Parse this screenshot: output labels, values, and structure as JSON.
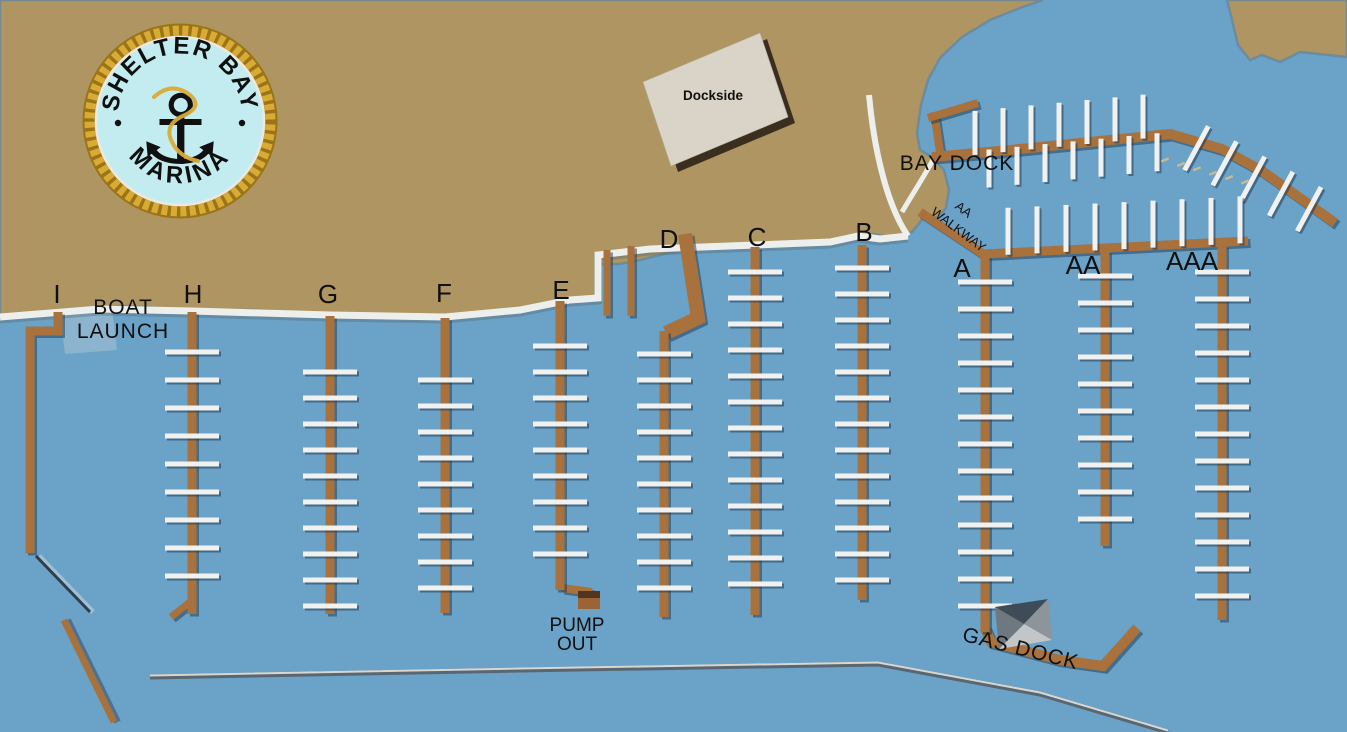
{
  "title": "Shelter Bay Marina map",
  "logo": {
    "arc_top": "SHELTER BAY",
    "arc_bottom": "MARINA",
    "dot": "•",
    "anchor_icon": "⚓"
  },
  "colors": {
    "water": "#6ba2c8",
    "land": "#ae9562",
    "land_edge": "#5d86a4",
    "dock": "#a9713c",
    "dock_shadow": "rgba(25,55,80,0.5)",
    "pier": "#f1f2ef",
    "pier_shadow": "rgba(22,50,75,0.5)",
    "walkway": "#edefec",
    "walkway_shadow": "rgba(90,110,120,0.45)",
    "ramp": "#8db4cf",
    "breakwater_dark": "#2e3e4a",
    "breakwater_light": "#d8d8d2",
    "breakwater_mid": "#5a6671",
    "building_fill": "#dad4c8",
    "building_shadow": "#3a2f1f",
    "gas_roof_dark": "#3e4c57",
    "gas_roof_left": "#6e787e",
    "gas_roof_right": "#8d959a",
    "gas_roof_light": "#c2c6c8",
    "pump_box": "#9c6434",
    "pump_box_dark": "#52351c",
    "buoy": "#cbb98f",
    "logo_rope": "#d9ab35",
    "logo_rope_dark": "#9a7518",
    "logo_face": "#c2ecef",
    "logo_text": "#111111",
    "label": "#111111"
  },
  "labels": [
    {
      "id": "dock-label-i",
      "text": "I",
      "x": 57,
      "y": 303,
      "s": 26
    },
    {
      "id": "boat-launch-line1",
      "text": "BOAT",
      "x": 123,
      "y": 314,
      "s": 21,
      "ls": 1
    },
    {
      "id": "boat-launch-line2",
      "text": "LAUNCH",
      "x": 123,
      "y": 338,
      "s": 21,
      "ls": 1
    },
    {
      "id": "dock-label-h",
      "text": "H",
      "x": 193,
      "y": 303,
      "s": 26
    },
    {
      "id": "dock-label-g",
      "text": "G",
      "x": 328,
      "y": 303,
      "s": 26
    },
    {
      "id": "dock-label-f",
      "text": "F",
      "x": 444,
      "y": 302,
      "s": 26
    },
    {
      "id": "dock-label-e",
      "text": "E",
      "x": 561,
      "y": 299,
      "s": 26
    },
    {
      "id": "dock-label-d",
      "text": "D",
      "x": 669,
      "y": 248,
      "s": 26
    },
    {
      "id": "dock-label-c",
      "text": "C",
      "x": 757,
      "y": 246,
      "s": 26
    },
    {
      "id": "dock-label-b",
      "text": "B",
      "x": 864,
      "y": 241,
      "s": 26
    },
    {
      "id": "dock-label-a",
      "text": "A",
      "x": 962,
      "y": 277,
      "s": 26
    },
    {
      "id": "dock-label-aa",
      "text": "AA",
      "x": 1083,
      "y": 274,
      "s": 26
    },
    {
      "id": "dock-label-aaa",
      "text": "AAA",
      "x": 1192,
      "y": 270,
      "s": 26
    },
    {
      "id": "bay-dock-label",
      "text": "BAY DOCK",
      "x": 957,
      "y": 170,
      "s": 21,
      "ls": 1
    },
    {
      "id": "aa-walkway-line1",
      "text": "AA",
      "x": 961,
      "y": 213,
      "s": 13,
      "r": 37
    },
    {
      "id": "aa-walkway-line2",
      "text": "WALKWAY",
      "x": 956,
      "y": 233,
      "s": 13,
      "r": 37
    },
    {
      "id": "pump-out-line1",
      "text": "PUMP",
      "x": 577,
      "y": 631,
      "s": 19
    },
    {
      "id": "pump-out-line2",
      "text": "OUT",
      "x": 577,
      "y": 650,
      "s": 19
    },
    {
      "id": "gas-dock-label",
      "text": "GAS DOCK",
      "x": 1019,
      "y": 655,
      "s": 21,
      "r": 14,
      "ls": 1
    },
    {
      "id": "dockside-label",
      "text": "Dockside",
      "x": 713,
      "y": 100,
      "s": 13.5,
      "w": 700
    }
  ],
  "map": {
    "vertical_docks": [
      {
        "label": "H",
        "x": 192,
        "top": 312,
        "bottom": 614,
        "p0": 352,
        "p1": 600,
        "sp": 28
      },
      {
        "label": "G",
        "x": 330,
        "top": 316,
        "bottom": 614,
        "p0": 372,
        "p1": 606,
        "sp": 26
      },
      {
        "label": "F",
        "x": 445,
        "top": 318,
        "bottom": 613,
        "p0": 380,
        "p1": 606,
        "sp": 26
      },
      {
        "label": "E",
        "x": 560,
        "top": 301,
        "bottom": 590,
        "p0": 346,
        "p1": 578,
        "sp": 26
      },
      {
        "label": "D",
        "x": 664,
        "top": 331,
        "bottom": 617,
        "p0": 354,
        "p1": 608,
        "sp": 26
      },
      {
        "label": "C",
        "x": 755,
        "top": 247,
        "bottom": 615,
        "p0": 272,
        "p1": 608,
        "sp": 26
      },
      {
        "label": "B",
        "x": 862,
        "top": 245,
        "bottom": 600,
        "p0": 268,
        "p1": 594,
        "sp": 26
      },
      {
        "label": "A",
        "x": 985,
        "top": 256,
        "bottom": 632,
        "p0": 282,
        "p1": 622,
        "sp": 27
      },
      {
        "label": "AA",
        "x": 1105,
        "top": 251,
        "bottom": 546,
        "p0": 276,
        "p1": 540,
        "sp": 27
      },
      {
        "label": "AAA",
        "x": 1222,
        "top": 246,
        "bottom": 620,
        "p0": 272,
        "p1": 612,
        "sp": 27
      }
    ],
    "stub_piers": [
      {
        "x": 607,
        "top": 250,
        "bottom": 316
      },
      {
        "x": 631,
        "top": 246,
        "bottom": 316
      }
    ],
    "i_dock": [
      [
        58,
        312
      ],
      [
        58,
        331
      ],
      [
        30,
        331
      ],
      [
        30,
        553
      ]
    ],
    "h_hook": [
      [
        190,
        602
      ],
      [
        171,
        617
      ]
    ],
    "d_slant": [
      [
        685,
        234
      ],
      [
        698,
        318
      ],
      [
        666,
        333
      ]
    ],
    "pump_stub": [
      [
        562,
        588
      ],
      [
        592,
        592
      ]
    ],
    "bay_dock": {
      "path": [
        [
          932,
          157
        ],
        [
          1010,
          150
        ],
        [
          1090,
          142
        ],
        [
          1170,
          134
        ],
        [
          1222,
          149
        ],
        [
          1262,
          171
        ],
        [
          1335,
          223
        ]
      ],
      "up_piers": {
        "x0": 975,
        "x1": 1160,
        "sp": 28,
        "len": 42
      },
      "down_piers": {
        "x0": 989,
        "x1": 1158,
        "sp": 28,
        "len": 36
      },
      "diag_pier_ts": [
        30,
        62,
        94,
        126,
        158
      ]
    },
    "t_dock": [
      [
        [
          940,
          152
        ],
        [
          934,
          112
        ]
      ],
      [
        [
          928,
          118
        ],
        [
          978,
          103
        ]
      ]
    ],
    "a_walkway": {
      "path": [
        [
          920,
          212
        ],
        [
          983,
          254
        ],
        [
          1248,
          241
        ]
      ],
      "up_piers": {
        "x0": 1008,
        "x1": 1240,
        "sp": 29,
        "len": 45
      }
    },
    "gas_dock_path": [
      [
        985,
        628
      ],
      [
        991,
        642
      ],
      [
        1060,
        660
      ],
      [
        1103,
        666
      ],
      [
        1137,
        628
      ]
    ],
    "breakwaters": {
      "long": [
        [
          150,
          677
        ],
        [
          520,
          670
        ],
        [
          878,
          664
        ],
        [
          1040,
          694
        ],
        [
          1168,
          732
        ]
      ],
      "left_dark": [
        [
          36,
          556
        ],
        [
          90,
          612
        ]
      ],
      "left_brown": [
        [
          64,
          620
        ],
        [
          114,
          722
        ]
      ]
    },
    "buoys": {
      "from": [
        1165,
        160
      ],
      "to": [
        1245,
        182
      ],
      "count": 6
    },
    "walkways": {
      "shore": [
        [
          0,
          317
        ],
        [
          100,
          309
        ],
        [
          192,
          311
        ],
        [
          330,
          315
        ],
        [
          445,
          317
        ],
        [
          520,
          310
        ],
        [
          570,
          300
        ],
        [
          598,
          298
        ],
        [
          598,
          255
        ],
        [
          650,
          249
        ],
        [
          755,
          245
        ],
        [
          830,
          242
        ],
        [
          858,
          236
        ],
        [
          880,
          239
        ],
        [
          908,
          236
        ]
      ],
      "road": "M908,236 C890,210 875,160 869,95",
      "road_branch": "M902,212 C915,190 925,175 934,158"
    },
    "ramp": [
      [
        60,
        311
      ],
      [
        112,
        308
      ],
      [
        117,
        350
      ],
      [
        65,
        354
      ]
    ],
    "dockside_building": {
      "poly": [
        [
          643,
          82
        ],
        [
          760,
          33
        ],
        [
          788,
          117
        ],
        [
          671,
          166
        ]
      ],
      "shadow": [
        [
          650,
          88
        ],
        [
          767,
          39
        ],
        [
          795,
          123
        ],
        [
          678,
          172
        ]
      ]
    },
    "gas_building": {
      "corners": [
        [
          995,
          607
        ],
        [
          1048,
          599
        ],
        [
          1052,
          640
        ],
        [
          999,
          649
        ]
      ],
      "center": [
        1024,
        624
      ]
    },
    "pump_box": {
      "x": 578,
      "y": 591,
      "w": 22,
      "h": 18
    },
    "land_main": "M0,0 L1043,0 L1020,8 L990,20 L962,37 L940,58 L928,80 L921,105 L917,133 L920,150 L932,157 L944,170 L949,190 L946,208 L938,218 L926,215 L912,232 L894,238 L874,234 L856,238 L800,244 L757,246 L712,247 L668,253 L640,260 L620,264 L600,264 L600,299 L560,304 L500,313 L446,318 L380,316 L330,315 L260,310 L193,310 L120,306 L60,310 L0,317 Z",
    "land_topright": "M1227,0 L1347,0 L1347,57 L1300,52 L1280,62 L1262,55 L1250,60 L1238,45 L1232,20 Z",
    "logo": {
      "cx": 180,
      "cy": 121,
      "r": 95
    }
  }
}
